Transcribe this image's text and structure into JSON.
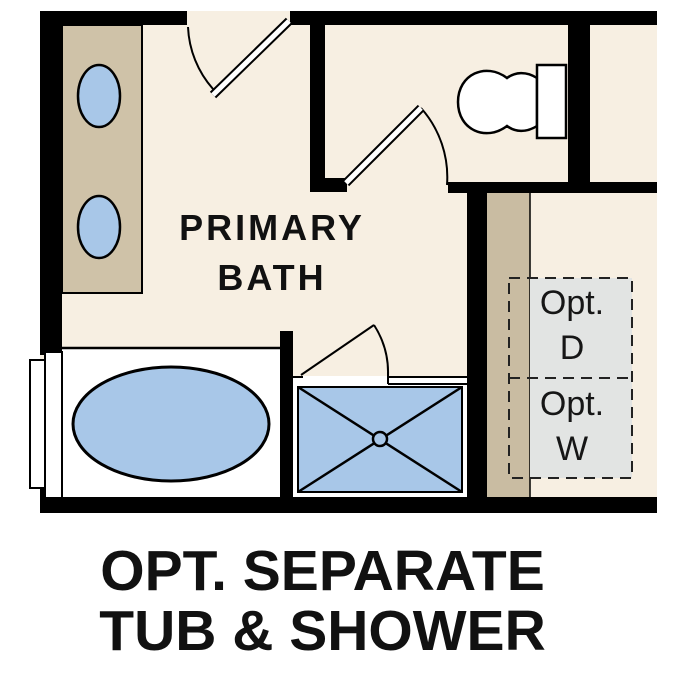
{
  "floor_plan": {
    "room_label": {
      "line1": "PRIMARY",
      "line2": "BATH"
    },
    "caption": {
      "line1": "OPT. SEPARATE",
      "line2": "TUB & SHOWER"
    },
    "optional_dryer": {
      "line1": "Opt.",
      "line2": "D"
    },
    "optional_washer": {
      "line1": "Opt.",
      "line2": "W"
    },
    "fixtures": [
      "vanity-with-double-sinks",
      "toilet",
      "bathtub",
      "shower-with-glass-door",
      "window",
      "entry-door",
      "bath-door",
      "optional-washer-dryer-area"
    ],
    "colors": {
      "walls": "#000000",
      "floor": "#f7efe2",
      "casework_tan": "#cfc2a8",
      "laundry_tan": "#c9bca2",
      "plumbing_blue": "#a8c7e8",
      "fixture_white": "#ffffff",
      "optional_area_gray": "#e2e4e3",
      "text": "#111111"
    }
  }
}
